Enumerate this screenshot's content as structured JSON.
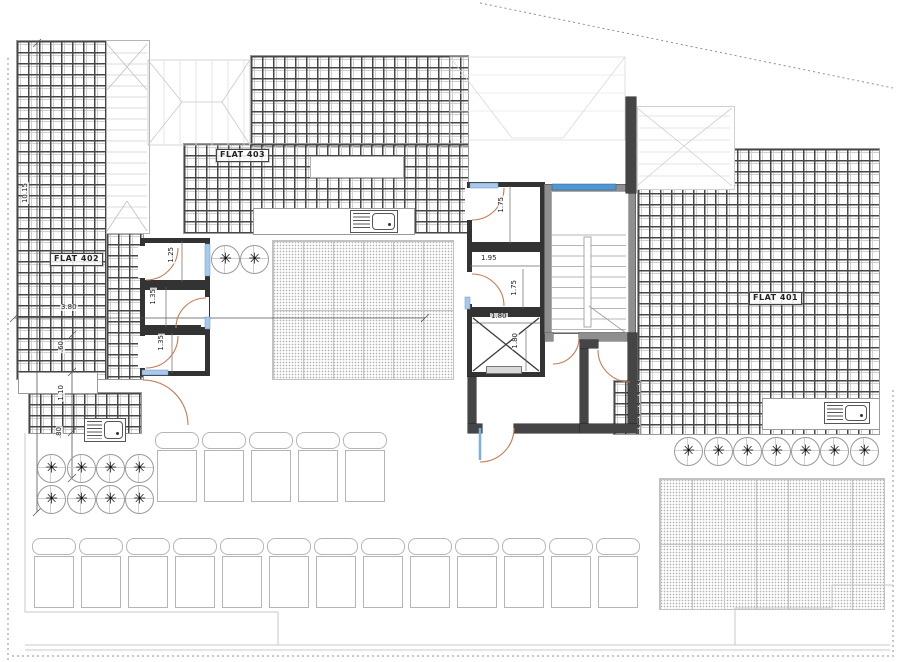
{
  "drawing": {
    "type": "architectural-roof-floor-plan",
    "flat_labels": [
      {
        "id": "flat-403",
        "text": "FLAT 403",
        "x": 216,
        "y": 149
      },
      {
        "id": "flat-402",
        "text": "FLAT 402",
        "x": 50,
        "y": 253
      },
      {
        "id": "flat-401",
        "text": "FLAT 401",
        "x": 749,
        "y": 292
      }
    ],
    "dimensions": [
      {
        "text": "10.15",
        "x": 22,
        "y": 182,
        "vertical": true
      },
      {
        "text": "3.80",
        "x": 60,
        "y": 304,
        "vertical": false
      },
      {
        "text": "1.25",
        "x": 168,
        "y": 246,
        "vertical": true
      },
      {
        "text": "1.35",
        "x": 150,
        "y": 288,
        "vertical": true
      },
      {
        "text": "1.35",
        "x": 158,
        "y": 334,
        "vertical": true
      },
      {
        "text": ".60",
        "x": 58,
        "y": 340,
        "vertical": true
      },
      {
        "text": "1.10",
        "x": 58,
        "y": 384,
        "vertical": true
      },
      {
        "text": ".80",
        "x": 56,
        "y": 426,
        "vertical": true
      },
      {
        "text": "1.75",
        "x": 498,
        "y": 196,
        "vertical": true
      },
      {
        "text": "1.95",
        "x": 480,
        "y": 255,
        "vertical": false
      },
      {
        "text": "1.75",
        "x": 511,
        "y": 279,
        "vertical": true
      },
      {
        "text": "1.80",
        "x": 490,
        "y": 313,
        "vertical": false
      },
      {
        "text": "1.80",
        "x": 512,
        "y": 332,
        "vertical": true
      }
    ],
    "plants": {
      "left_group": [
        [
          50,
          467
        ],
        [
          80,
          467
        ],
        [
          109,
          467
        ],
        [
          138,
          467
        ],
        [
          50,
          498
        ],
        [
          80,
          498
        ],
        [
          109,
          498
        ],
        [
          138,
          498
        ]
      ],
      "courtyard": [
        [
          224,
          258
        ],
        [
          253,
          258
        ]
      ],
      "right_row": [
        [
          687,
          450
        ],
        [
          717,
          450
        ],
        [
          746,
          450
        ],
        [
          775,
          450
        ],
        [
          804,
          450
        ],
        [
          833,
          450
        ],
        [
          863,
          450
        ]
      ]
    },
    "loungers": {
      "row1": {
        "y": 432,
        "xs": [
          155,
          202,
          249,
          296,
          343
        ]
      },
      "row2": {
        "y": 538,
        "xs": [
          32,
          79,
          126,
          173,
          220,
          267,
          314,
          361,
          408,
          455,
          502,
          549,
          596
        ]
      }
    },
    "colors": {
      "door_arc": "#c87a55",
      "window_blue": "#4f97d0",
      "window_light": "#a9c9ea",
      "wall_dark": "#454545",
      "wall_gray": "#8f8f8f",
      "tile_line": "#474747"
    }
  }
}
